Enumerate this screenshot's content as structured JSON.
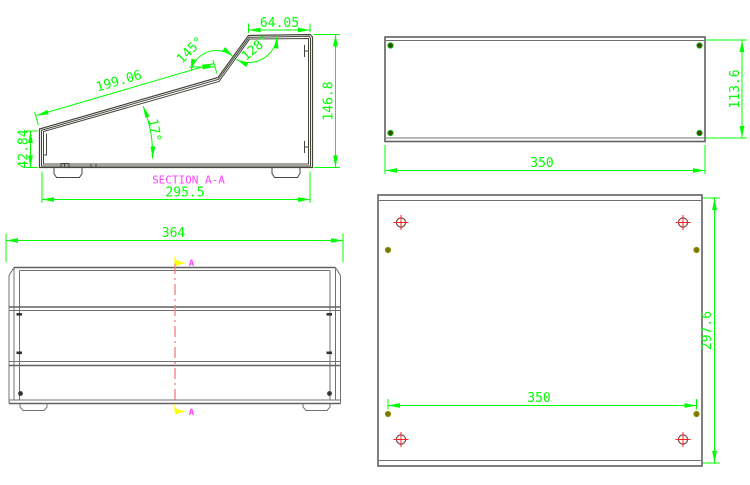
{
  "colors": {
    "dimension_green": "#00ff00",
    "outline_dark": "#45453c",
    "panel_gray": "#606060",
    "section_label_magenta": "#ff44ff",
    "cut_line_salmon": "#f08080",
    "view_arrow_yellow": "#ffff00",
    "hole_cross_red": "#ff2222",
    "screw_olive": "#767600"
  },
  "section_view": {
    "label": "SECTION A-A",
    "top_width": "64.05",
    "upper_bend_angle": "145°",
    "top_bend_angle": "128°",
    "slope_length": "199.06",
    "slope_angle": "17°",
    "left_height": "42.84",
    "right_height": "146.8",
    "bottom_width": "295.5"
  },
  "front_view": {
    "overall_width": "364",
    "section_marker_top": "A",
    "section_marker_bottom": "A"
  },
  "back_view": {
    "width": "350",
    "height": "113.6"
  },
  "bottom_view": {
    "screw_spacing": "350",
    "depth": "297.6"
  }
}
